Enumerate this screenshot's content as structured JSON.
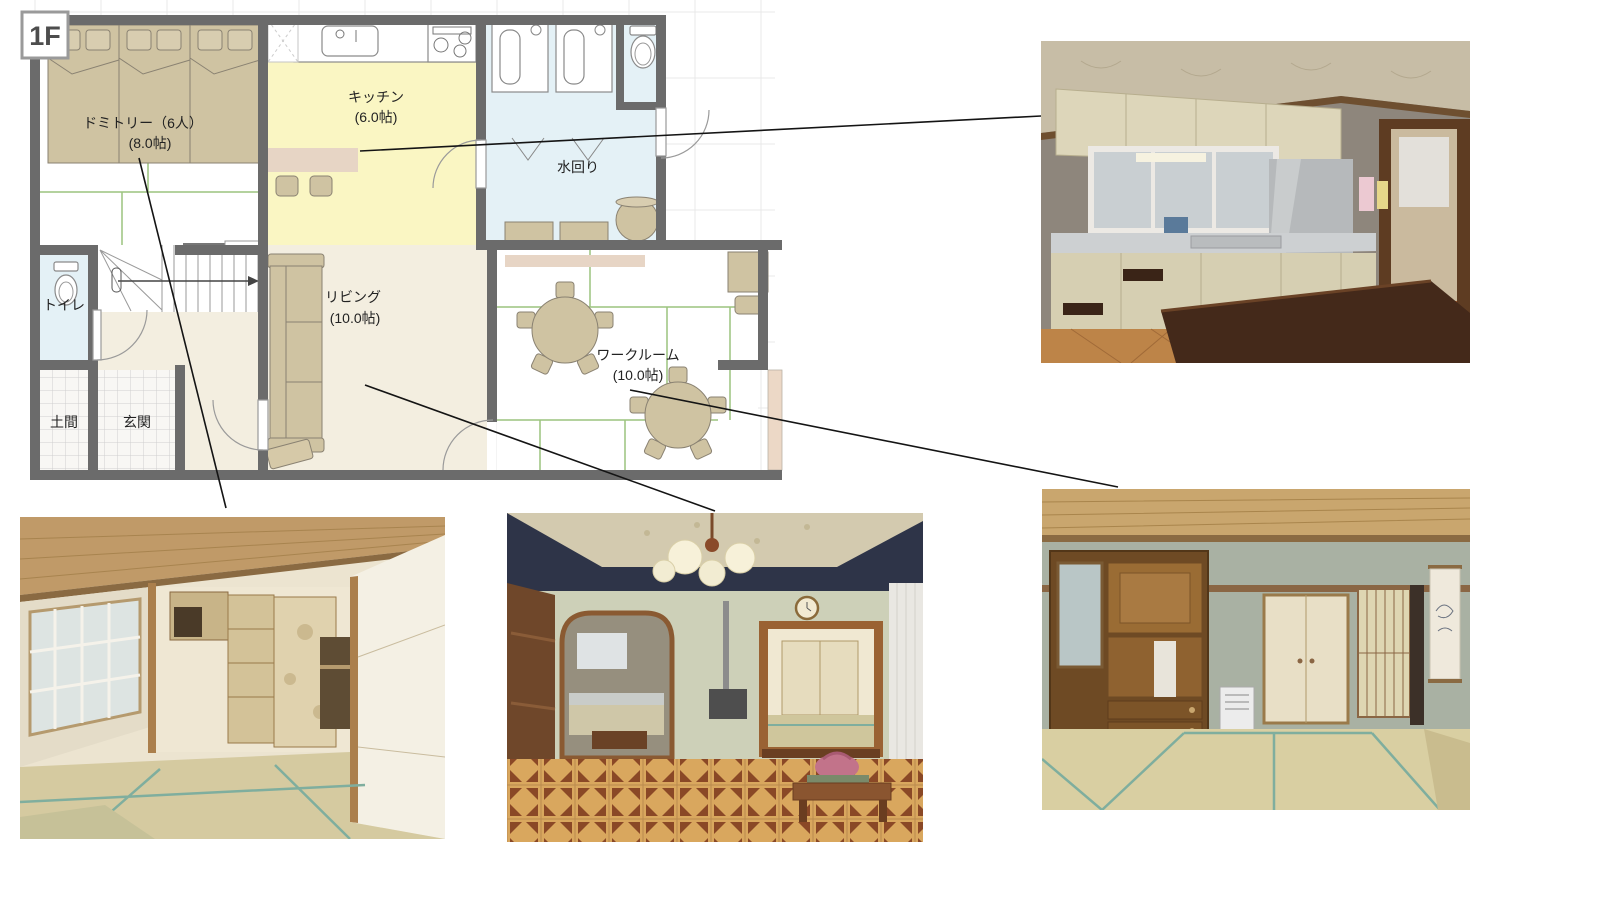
{
  "page": {
    "background": "#ffffff"
  },
  "floor_plan": {
    "floor_label": "1F",
    "rooms": {
      "dormitory": {
        "name": "ドミトリー（6人）",
        "size": "(8.0帖)"
      },
      "kitchen": {
        "name": "キッチン",
        "size": "(6.0帖)"
      },
      "water_area": {
        "name": "水回り"
      },
      "living": {
        "name": "リビング",
        "size": "(10.0帖)"
      },
      "workroom": {
        "name": "ワークルーム",
        "size": "(10.0帖)"
      },
      "toilet": {
        "name": "トイレ"
      },
      "doma": {
        "name": "土間"
      },
      "genkan": {
        "name": "玄関"
      }
    }
  },
  "photos": [
    {
      "id": "kitchen",
      "room": "キッチン",
      "position": "top-right"
    },
    {
      "id": "dormitory",
      "room": "ドミトリー",
      "position": "bottom-left"
    },
    {
      "id": "living",
      "room": "リビング",
      "position": "bottom-center"
    },
    {
      "id": "workroom",
      "room": "ワークルーム",
      "position": "bottom-right"
    }
  ],
  "connectors": [
    {
      "from_room": "キッチン",
      "to_photo": "kitchen"
    },
    {
      "from_room": "ドミトリー",
      "to_photo": "dormitory"
    },
    {
      "from_room": "リビング",
      "to_photo": "living"
    },
    {
      "from_room": "ワークルーム",
      "to_photo": "workroom"
    }
  ],
  "colors": {
    "wall": "#6b6b6b",
    "kitchen_fill": "#faf6c3",
    "water_fill": "#e4f1f6",
    "cream_fill": "#f3eee0",
    "furniture_tan": "#cfc3a2",
    "counter_pink": "#e7d5c5",
    "tatami_line": "#9cc47e",
    "connector": "#141414"
  }
}
